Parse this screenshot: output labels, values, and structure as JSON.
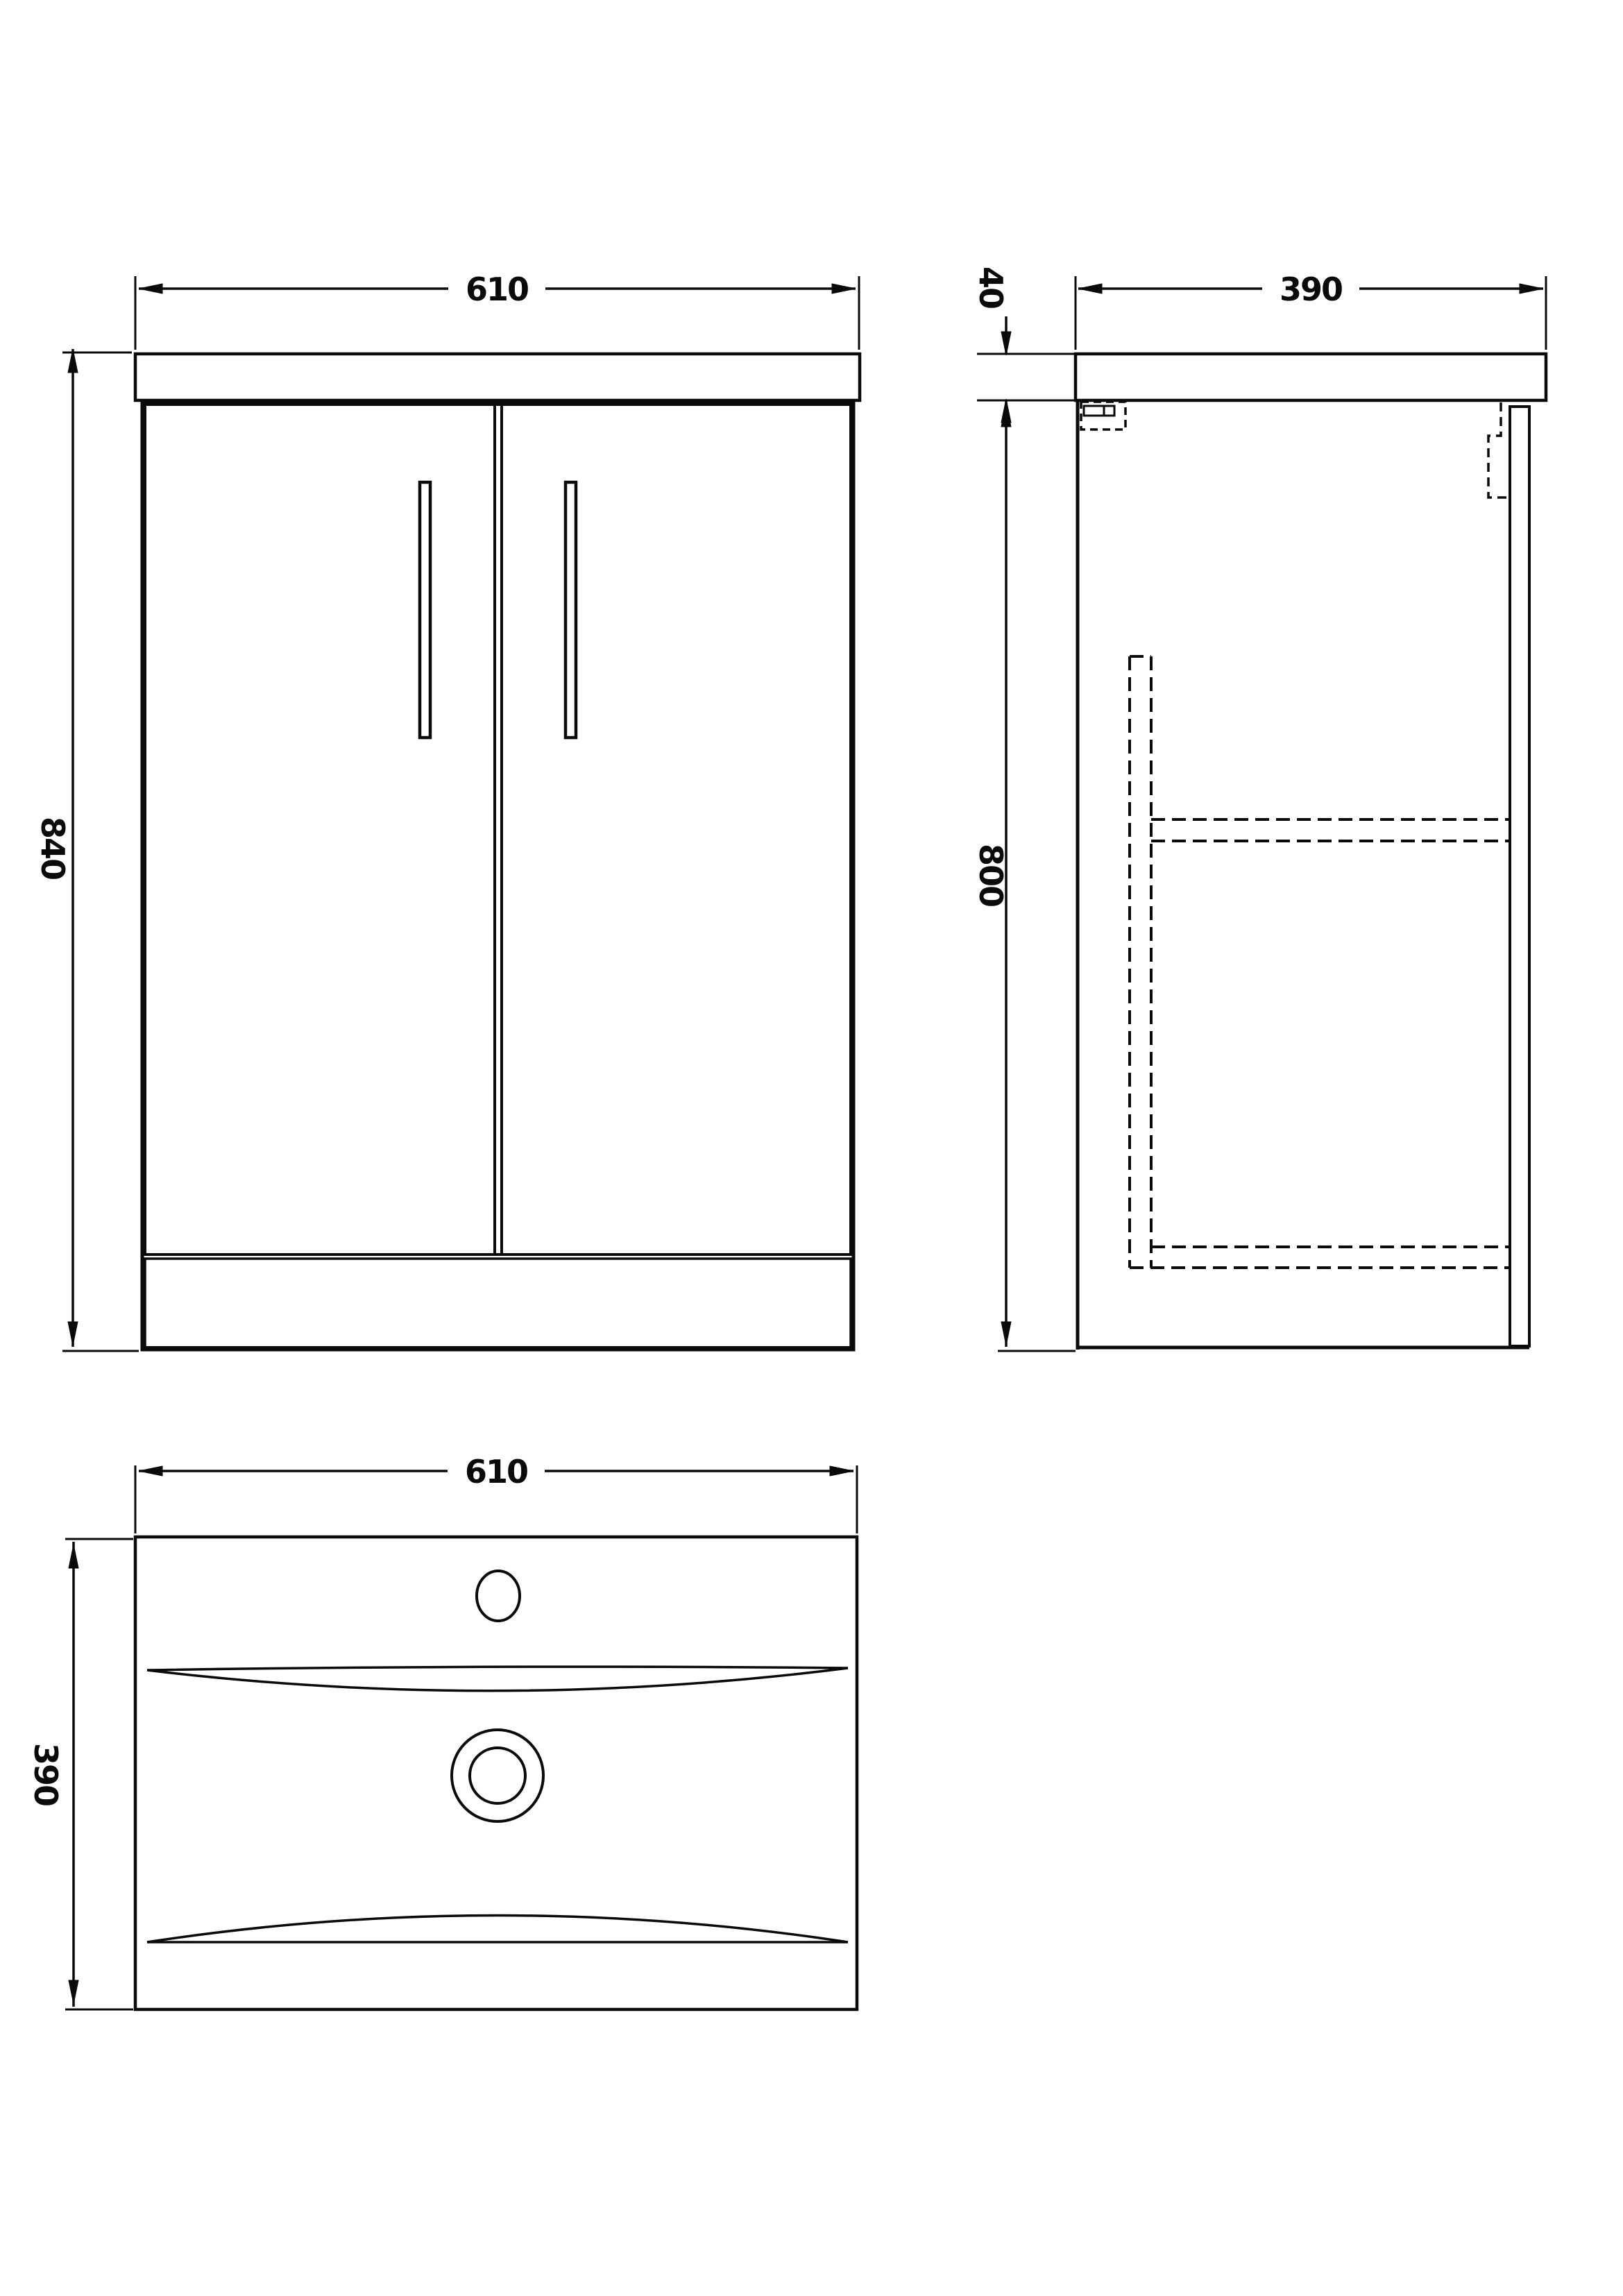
{
  "drawing": {
    "kind": "vanity-unit-technical-drawing",
    "colors": {
      "line": "#0a0a0a",
      "background": "#ffffff"
    },
    "views": {
      "front": {
        "label": "front-elevation",
        "width_label": "610",
        "height_label": "840"
      },
      "side": {
        "label": "side-elevation",
        "depth_label": "390",
        "worktop_thickness_label": "40",
        "carcass_height_label": "800"
      },
      "plan": {
        "label": "basin-plan",
        "width_label": "610",
        "depth_label": "390"
      }
    }
  }
}
